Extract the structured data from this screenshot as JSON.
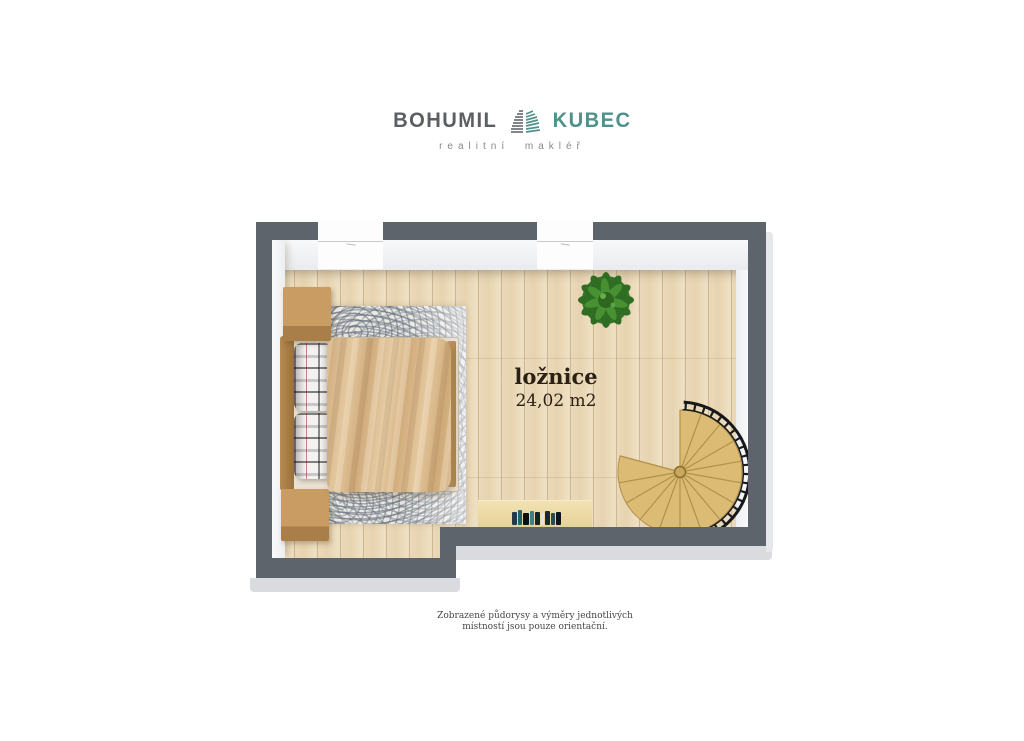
{
  "brand": {
    "name_primary": "BOHUMIL",
    "name_secondary": "KUBEC",
    "tagline": "realitní makléř"
  },
  "room": {
    "name": "ložnice",
    "area": "24,02 m2"
  },
  "disclaimer": {
    "line1": "Zobrazené půdorysy a výměry jednotlivých",
    "line2": "místností jsou pouze orientační."
  },
  "floorplan": {
    "windows": 2,
    "furniture": [
      "double-bed",
      "pillow",
      "pillow",
      "nightstand",
      "nightstand",
      "area-rug",
      "potted-plant",
      "desk",
      "books",
      "spiral-staircase"
    ]
  },
  "colors": {
    "brand_primary": "#5a5f64",
    "brand_teal": "#4f928b",
    "brand_tagline": "#85898d",
    "wall": "#5e646c",
    "wall_outer": "#d9dbde",
    "floor": "#e8d6b4",
    "rug": "#eae8e3",
    "label": "#2a2114",
    "disclaimer": "#474747"
  }
}
